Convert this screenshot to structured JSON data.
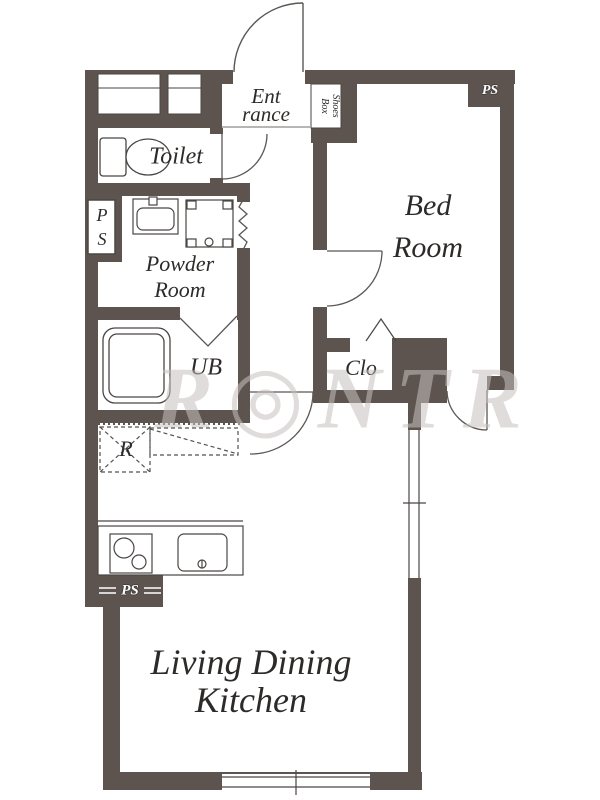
{
  "floorplan": {
    "rooms": {
      "entrance": {
        "line1": "Ent",
        "line2": "rance"
      },
      "shoes_box": {
        "line1": "Shoes",
        "line2": "Box"
      },
      "toilet": {
        "label": "Toilet"
      },
      "ps_shaft": {
        "line1": "P",
        "line2": "S"
      },
      "powder_room": {
        "line1": "Powder",
        "line2": "Room"
      },
      "unit_bath": {
        "label": "UB"
      },
      "bedroom": {
        "line1": "Bed",
        "line2": "Room"
      },
      "ps_bedroom": {
        "label": "PS"
      },
      "closet": {
        "label": "Clo"
      },
      "refrigerator_space": {
        "label": "R"
      },
      "ps_kitchen": {
        "label": "PS"
      },
      "living_dining_kitchen": {
        "line1": "Living Dining",
        "line2": "Kitchen"
      }
    },
    "watermark": "R◎NTR",
    "colors": {
      "wall": "#5d5450",
      "line": "#4a4643",
      "text": "#2d2b29",
      "background": "#ffffff"
    }
  }
}
